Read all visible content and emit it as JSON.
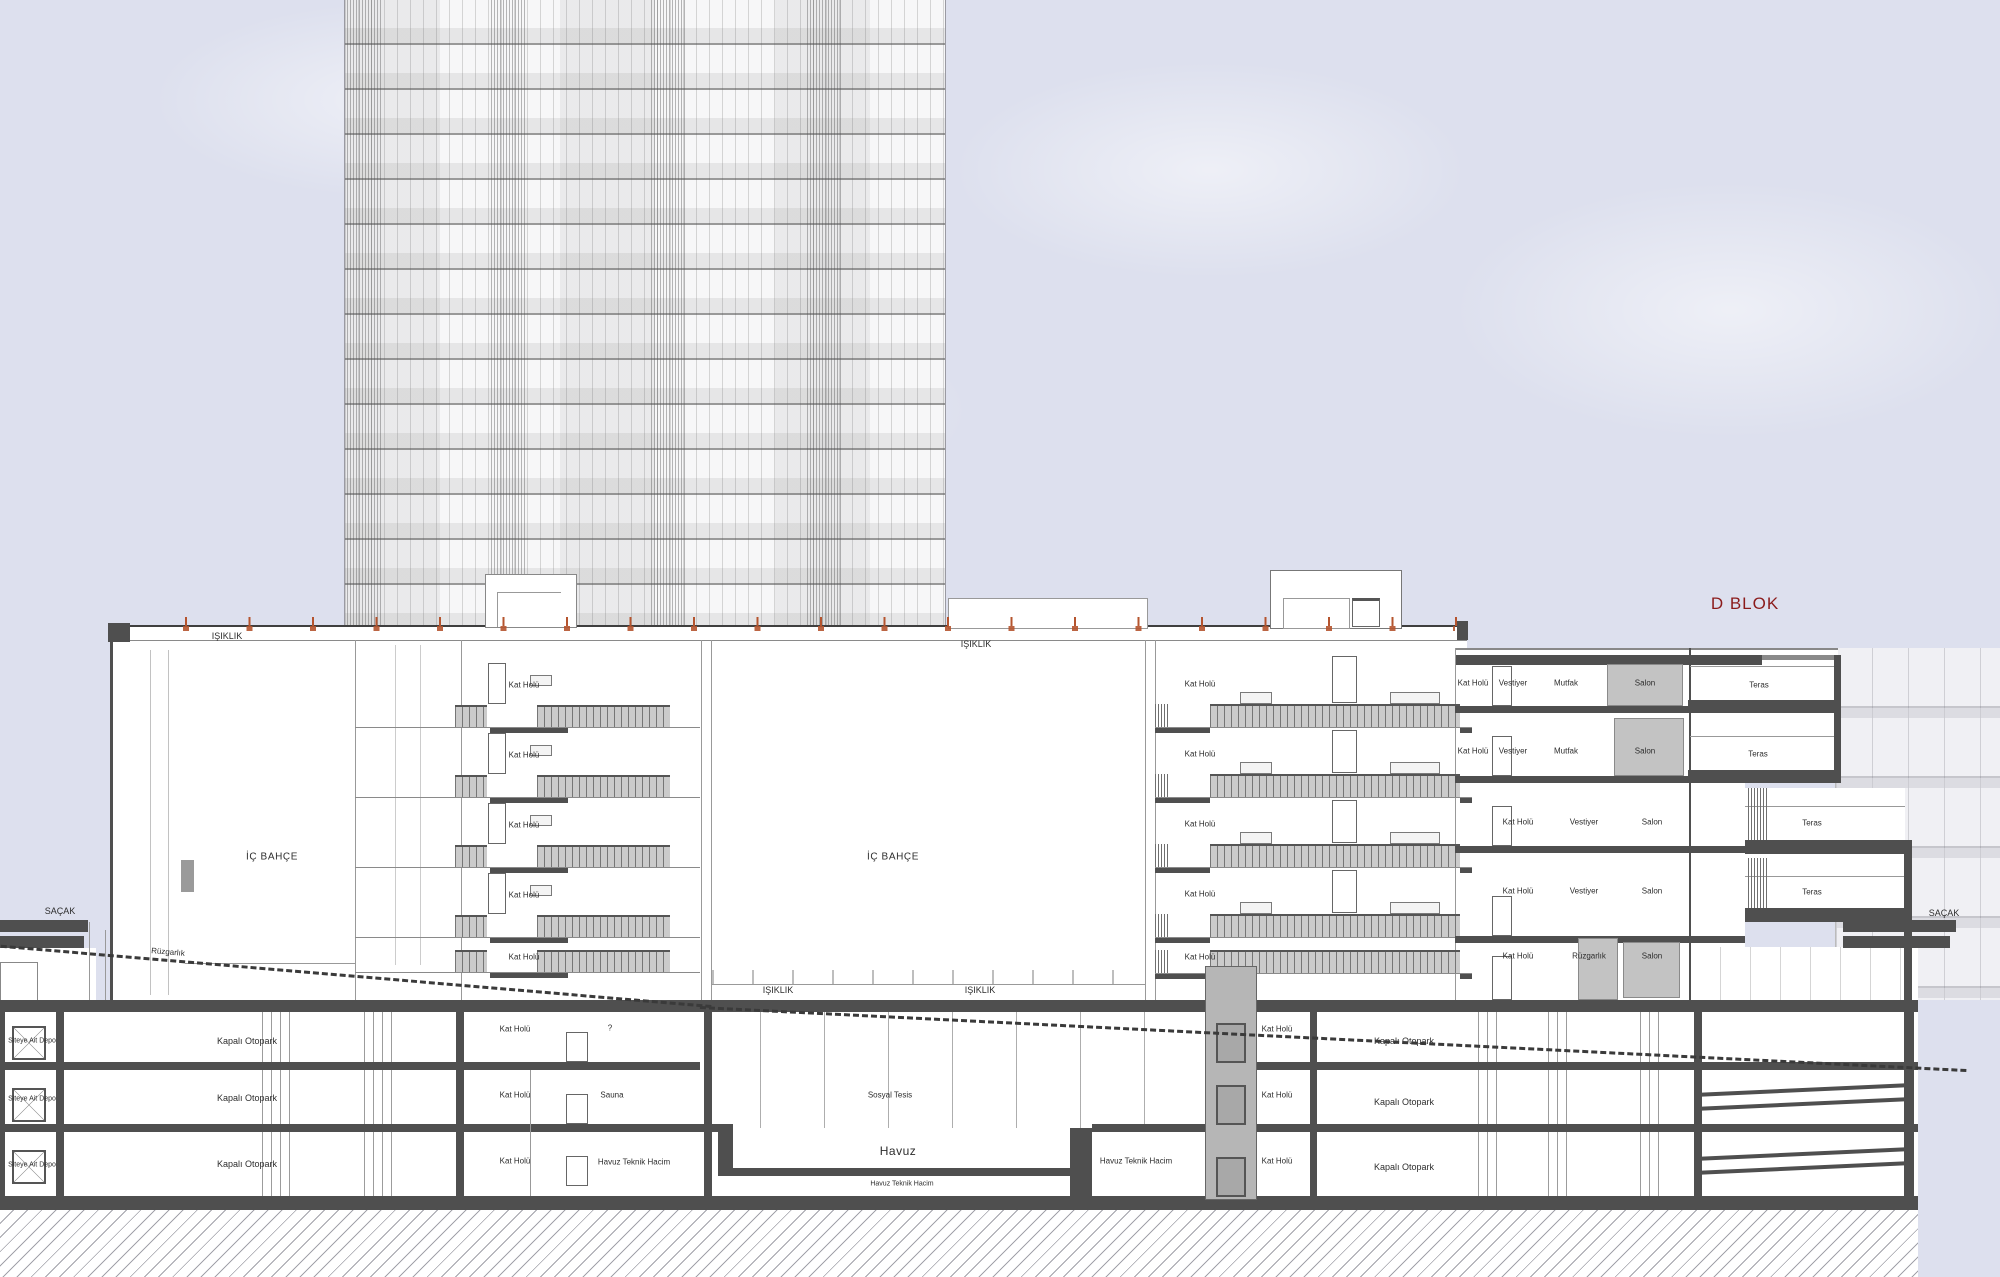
{
  "drawing": {
    "block_title": "D BLOK",
    "labels": {
      "ic_bahce": "İÇ BAHÇE",
      "isiklik": "IŞIKLIK",
      "sacak": "SAÇAK",
      "kat_holu": "Kat Holü",
      "vestiyer": "Vestiyer",
      "mutfak": "Mutfak",
      "salon": "Salon",
      "teras": "Teras",
      "ruzgarlik": "Rüzgarlık",
      "kapali_otopark": "Kapalı Otopark",
      "siteye_ait_depo": "Siteye Ait Depo",
      "sauna": "Sauna",
      "sosyal_tesis": "Sosyal Tesis",
      "havuz": "Havuz",
      "havuz_teknik_hacim": "Havuz Teknik Hacim",
      "soru": "?"
    },
    "colors": {
      "sky": "#dde0ee",
      "section_fill": "#ffffff",
      "slab": "#4f4f4f",
      "balcony_gray": "#cbcbcb",
      "roof_anchor_orange": "#b5542e",
      "title_red": "#8b1b1b",
      "elevator_gray": "#b6b6b6",
      "background_building": "#f0f0f4"
    }
  }
}
